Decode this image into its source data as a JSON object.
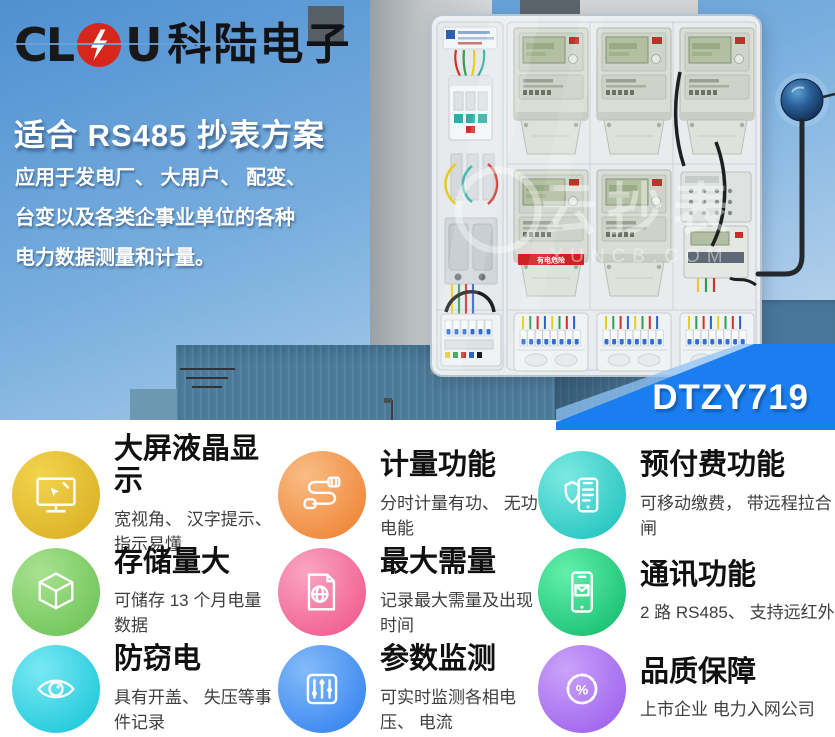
{
  "brand": {
    "letters_left": "CL",
    "letters_right": "U",
    "name_cn": "科陆电子"
  },
  "hero": {
    "title": "适合 RS485 抄表方案",
    "desc_lines": [
      "应用于发电厂、 大用户、 配变、",
      "台变以及各类企事业单位的各种",
      "电力数据测量和计量。"
    ],
    "model_badge": "DTZY719",
    "watermark": {
      "cn": "云抄表",
      "en": "YUNCB.COM"
    },
    "cabinet_warning": "有电危险",
    "colors": {
      "badge_blue": "#1a7ef0",
      "sky_top": "#4f90d1",
      "sky_bottom": "#c9ddf0",
      "building": "#4d7c9a",
      "logo_red": "#d7271d"
    }
  },
  "features": {
    "items": [
      {
        "title": "大屏液晶显示",
        "subtitle": "宽视角、 汉字提示、 指示易懂",
        "icon": "display-icon",
        "colors": [
          "#f2d44e",
          "#ddb429"
        ]
      },
      {
        "title": "计量功能",
        "subtitle": "分时计量有功、 无功电能",
        "icon": "cable-icon",
        "colors": [
          "#f9bd86",
          "#f08a3e"
        ]
      },
      {
        "title": "预付费功能",
        "subtitle": "可移动缴费， 带远程拉合闸",
        "icon": "shield-phone-icon",
        "colors": [
          "#7de9e3",
          "#2cc8c2"
        ]
      },
      {
        "title": "存储量大",
        "subtitle": "可储存 13 个月电量数据",
        "icon": "cube-icon",
        "colors": [
          "#a9e291",
          "#74c75d"
        ]
      },
      {
        "title": "最大需量",
        "subtitle": "记录最大需量及出现时间",
        "icon": "book-globe-icon",
        "colors": [
          "#f9a6c1",
          "#f26292"
        ]
      },
      {
        "title": "通讯功能",
        "subtitle": "2 路 RS485、 支持远红外",
        "icon": "phone-mail-icon",
        "colors": [
          "#63f0ab",
          "#1fc478"
        ]
      },
      {
        "title": "防窃电",
        "subtitle": "具有开盖、 失压等事件记录",
        "icon": "eye-icon",
        "colors": [
          "#79e9f4",
          "#27cbdd"
        ]
      },
      {
        "title": "参数监测",
        "subtitle": "可实时监测各相电压、 电流",
        "icon": "sliders-icon",
        "colors": [
          "#85bbf9",
          "#3e8af0"
        ]
      },
      {
        "title": "品质保障",
        "subtitle": "上市企业 电力入网公司",
        "icon": "seal-percent-icon",
        "colors": [
          "#caa3f9",
          "#a468ef"
        ]
      }
    ]
  }
}
